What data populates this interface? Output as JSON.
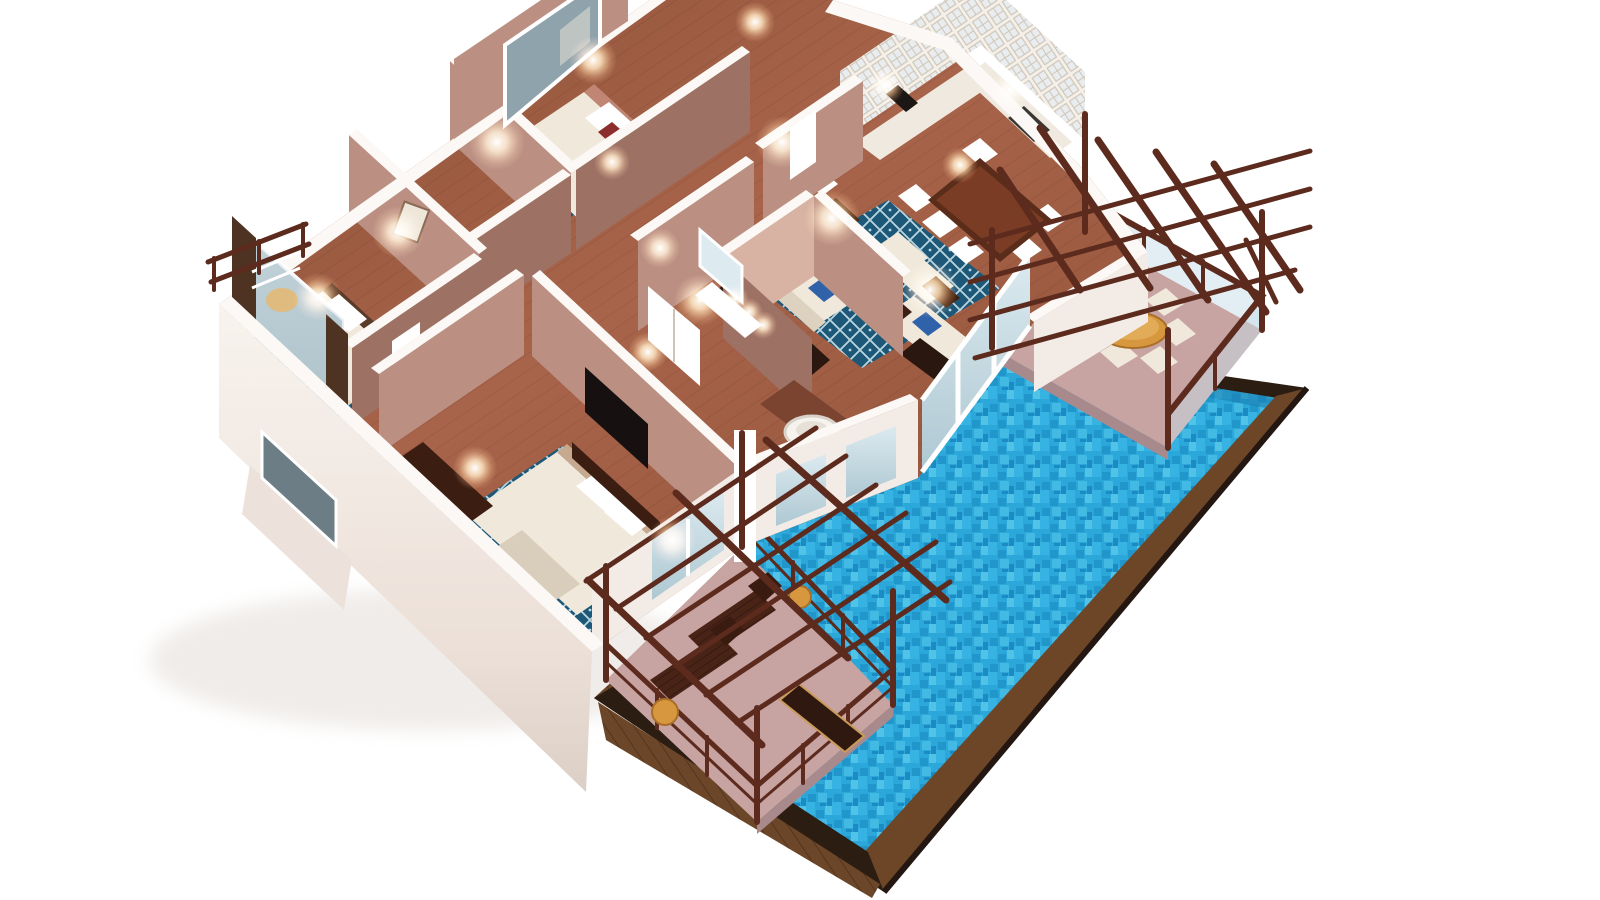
{
  "meta": {
    "title": "3D isometric cutaway floor plan render of a villa suite with private pool",
    "view": "aerial isometric cutaway, white background, no visible text"
  },
  "scene": {
    "rooms": [
      {
        "name": "bedroom-top",
        "features": [
          "double-bed",
          "red-accent-pillow",
          "window",
          "bedside-lamps"
        ]
      },
      {
        "name": "bedroom-left",
        "features": [
          "double-bed",
          "blue-lattice-rug",
          "picture-window",
          "curtains",
          "balcony-railing",
          "desk"
        ]
      },
      {
        "name": "master-bedroom",
        "features": [
          "double-bed",
          "blue-lattice-rug",
          "tv-console",
          "writing-desk"
        ]
      },
      {
        "name": "living-room",
        "features": [
          "white-sofas",
          "blue-accent-pillows",
          "blue-lattice-rug",
          "coffee-table",
          "table-lamps",
          "console-table"
        ]
      },
      {
        "name": "dining-area",
        "features": [
          "dark-wood-table",
          "six-white-chairs"
        ]
      },
      {
        "name": "kitchen",
        "features": [
          "white-glass-front-cabinets",
          "counter",
          "cooktop"
        ]
      },
      {
        "name": "bathroom-vanity",
        "features": [
          "double-vanity",
          "lit-mirror"
        ]
      },
      {
        "name": "bathroom-tub",
        "features": [
          "round-soaking-tub"
        ]
      },
      {
        "name": "hallway",
        "features": [
          "white-doors",
          "wall-sconces",
          "runner-rug"
        ]
      }
    ],
    "outdoor": [
      {
        "name": "dining-terrace",
        "features": [
          "wood-pergola",
          "round-table",
          "six-chairs",
          "glass-railing"
        ]
      },
      {
        "name": "lounge-terrace",
        "features": [
          "wood-pergola",
          "two-sun-loungers",
          "bench",
          "orange-side-tables",
          "railing"
        ]
      },
      {
        "name": "private-pool",
        "features": [
          "turquoise-mosaic-water",
          "l-shape",
          "dark-timber-deck-edge"
        ]
      }
    ]
  },
  "colors": {
    "background": "#ffffff",
    "exterior_wall": "#f3ece6",
    "wall_top": "#fbf8f5",
    "interior_wall": "#bb9083",
    "interior_wall_dark": "#9d7265",
    "interior_wall_light": "#d8b2a2",
    "floor_wood": "#96563d",
    "floor_wood_light": "#b4714f",
    "rug_blue": "#1d5878",
    "rug_lattice": "#bcd6e0",
    "sofa_cream": "#f0e9db",
    "pillow_blue": "#2f62a8",
    "pillow_red": "#8c2f2c",
    "furniture_wood": "#4a2418",
    "pergola_wood": "#5c2b1e",
    "terrace_floor": "#c7a3a2",
    "table_orange": "#d6973f",
    "pool_water": "#2ba7d9",
    "pool_water_deep": "#1b86bf",
    "pool_deck_wood": "#6d4527",
    "pool_deck_edge": "#2c1d13",
    "glass": "#c6dde8",
    "lamp_glow": "#ffc08a",
    "tv_screen": "#161010"
  }
}
